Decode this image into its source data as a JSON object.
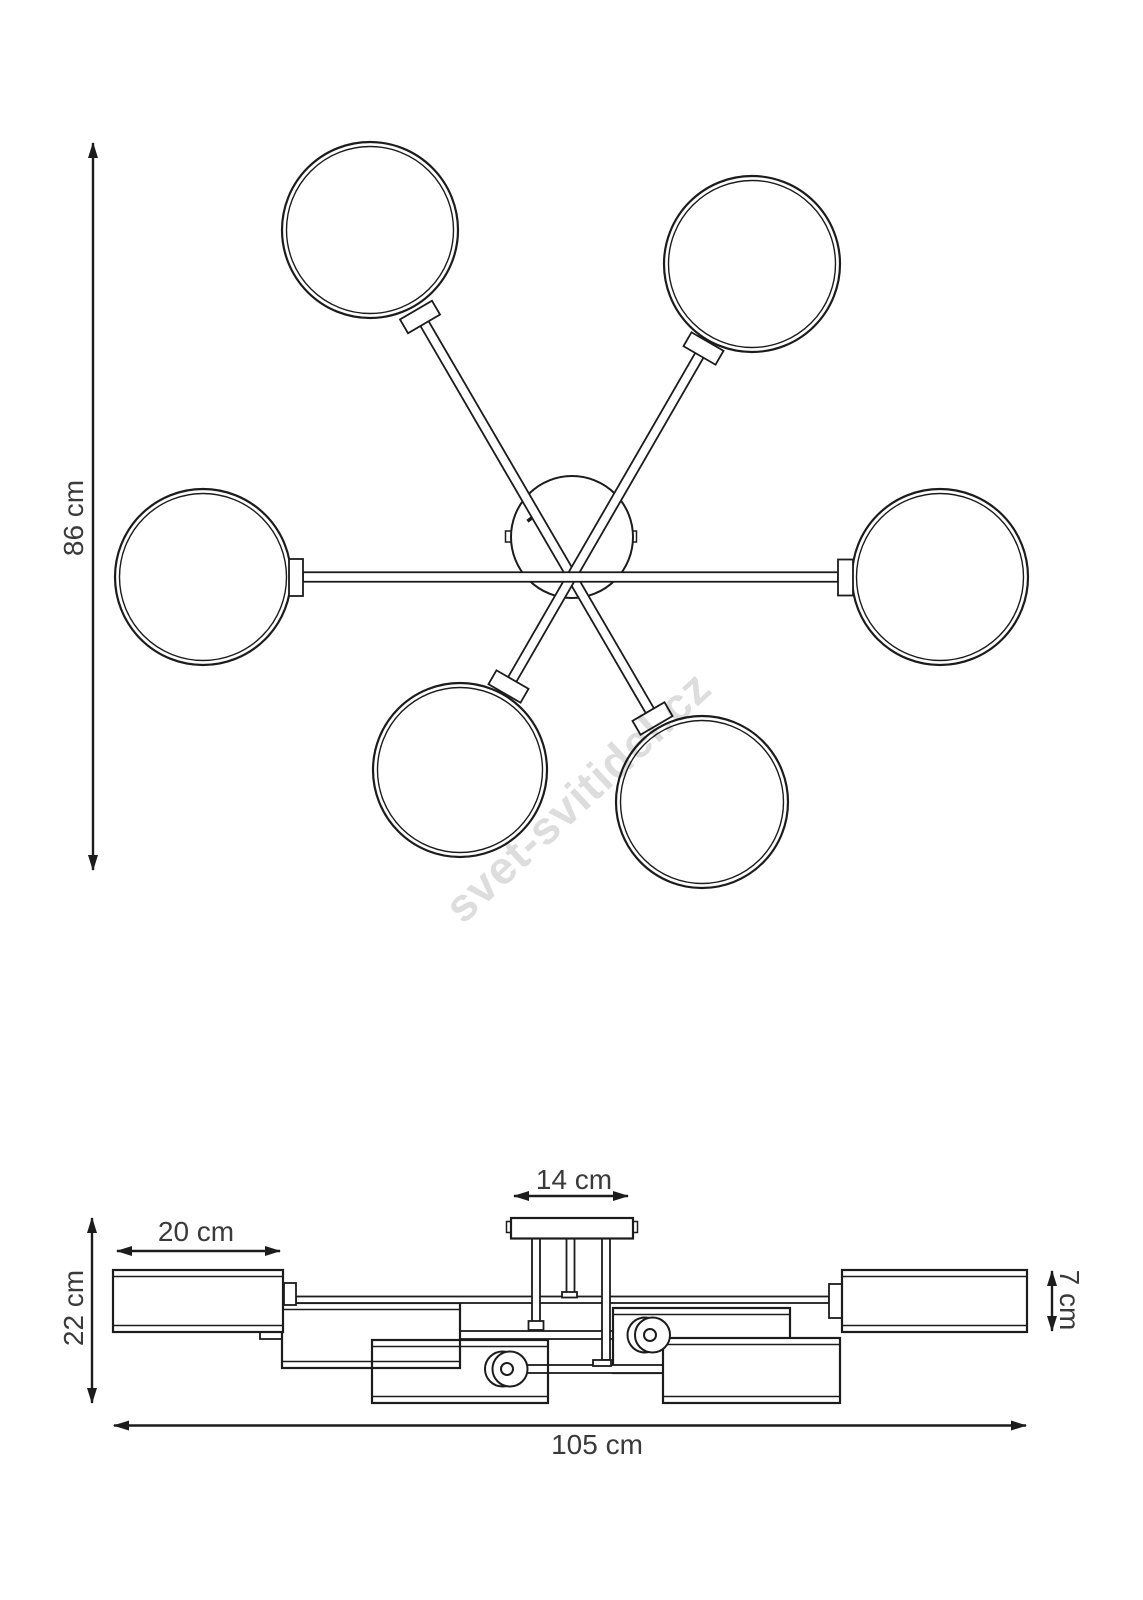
{
  "drawing": {
    "title": "ceiling-lamp-dimension-drawing",
    "watermark": "svet-svitidel.cz",
    "dimensions": {
      "overall_height": "86 cm",
      "overall_width": "105 cm",
      "side_height": "22 cm",
      "shade_width": "20 cm",
      "canopy_width": "14 cm",
      "shade_height": "7 cm"
    }
  }
}
